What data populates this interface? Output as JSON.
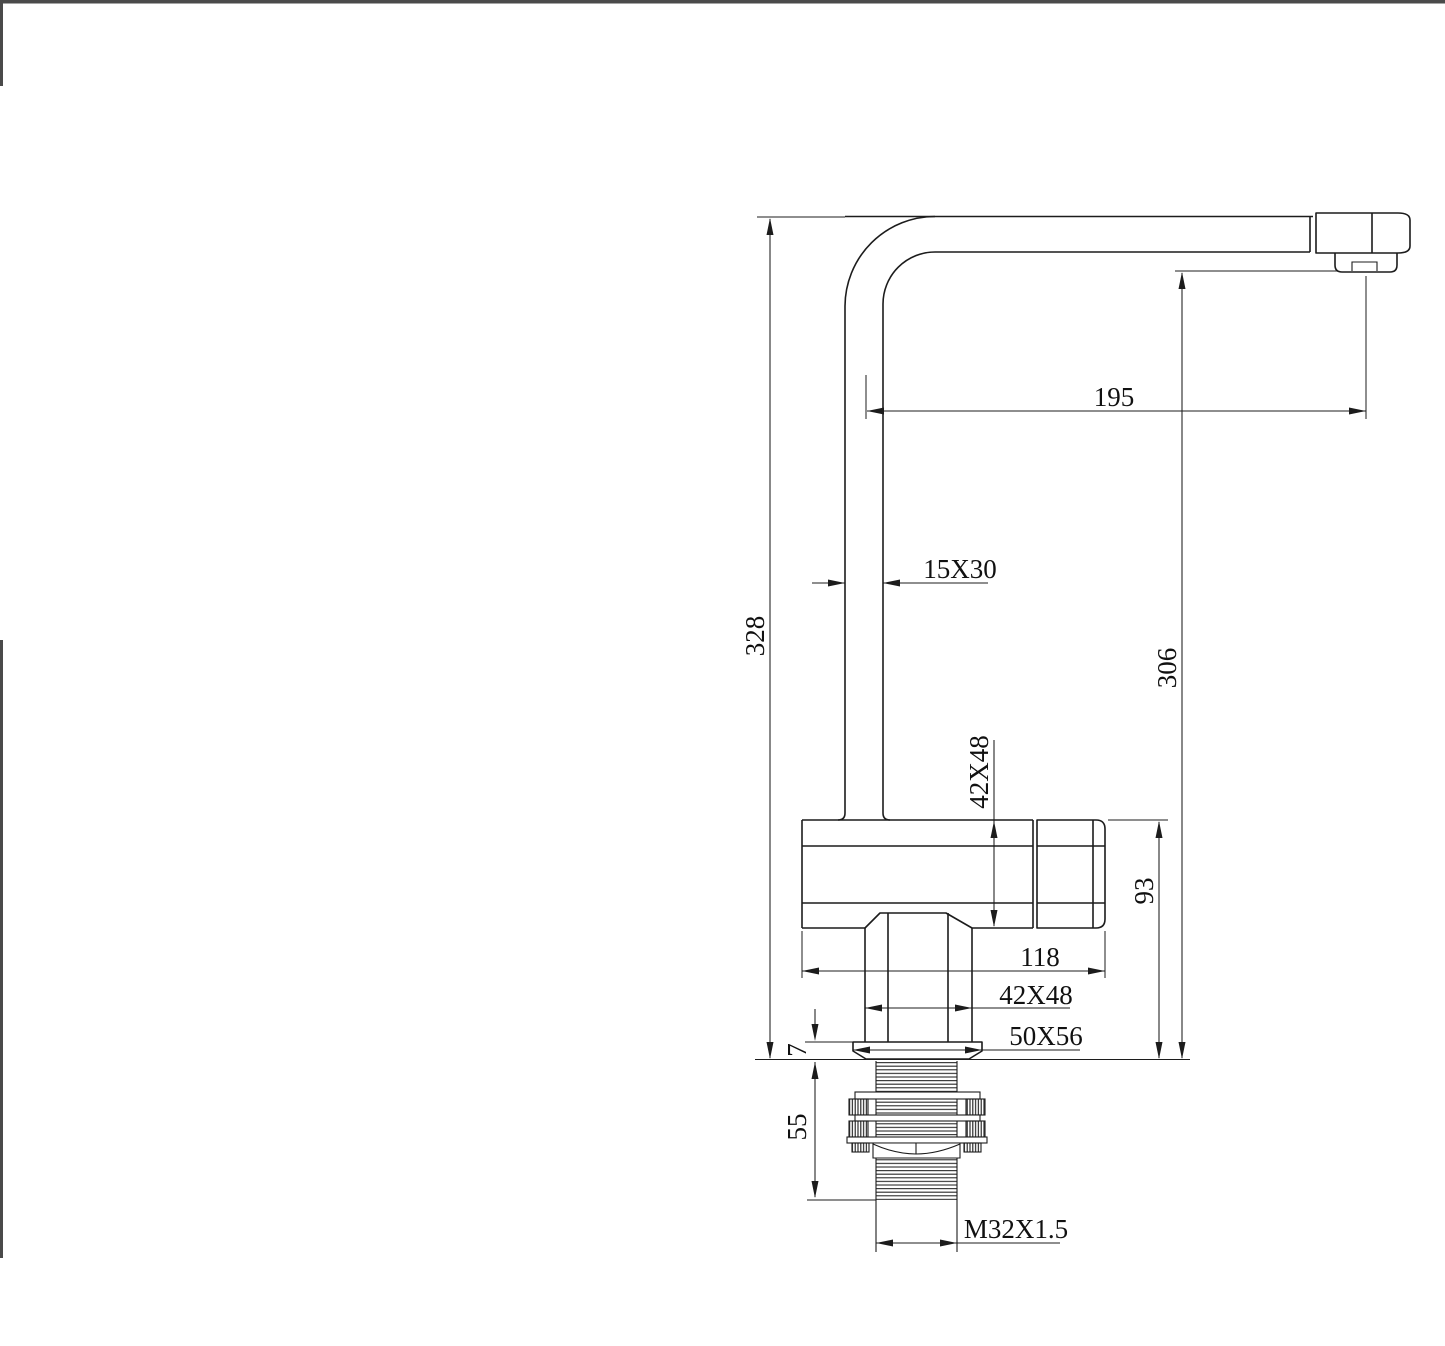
{
  "page": {
    "background": "#ffffff",
    "border_color": "#4a4a4a",
    "line_color": "#1c1c1c"
  },
  "drawing": {
    "view": "faucet side elevation",
    "dimensions": {
      "spout_reach": "195",
      "spout_tube_section": "15X30",
      "overall_height": "328",
      "outlet_height": "306",
      "body_section": "42X48",
      "body_height": "93",
      "body_length": "118",
      "stem_section": "42X48",
      "base_plate_section": "50X56",
      "flange_thickness": "7",
      "shank_length": "55",
      "thread_spec": "M32X1.5"
    }
  }
}
